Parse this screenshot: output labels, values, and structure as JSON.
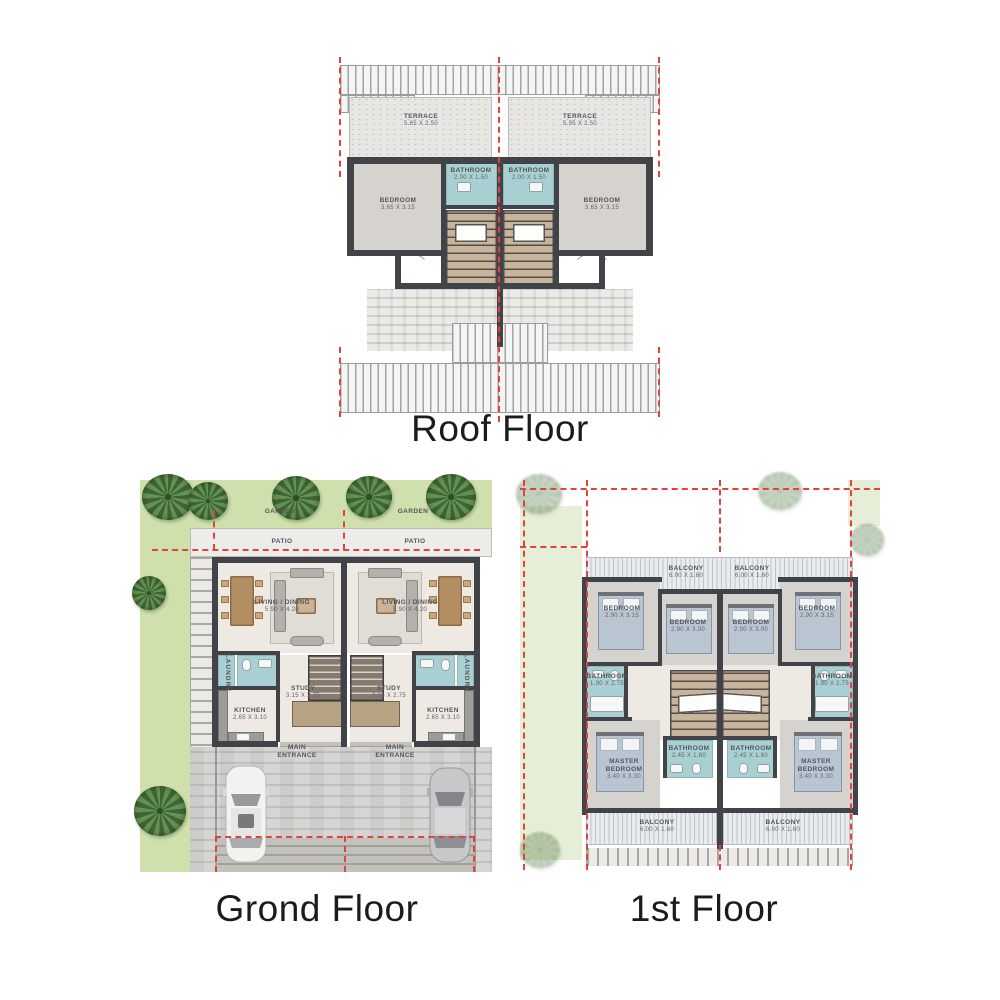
{
  "titles": {
    "roof": "Roof Floor",
    "ground": "Grond Floor",
    "first": "1st Floor"
  },
  "roof": {
    "terrace_left": {
      "label": "TERRACE",
      "dims": "5.65 X 2.50"
    },
    "terrace_right": {
      "label": "TERRACE",
      "dims": "5.95 X 2.50"
    },
    "bathroom_left": {
      "label": "BATHROOM",
      "dims": "2.00 X 1.50"
    },
    "bathroom_right": {
      "label": "BATHROOM",
      "dims": "2.00 X 1.50"
    },
    "bedroom_left": {
      "label": "BEDROOM",
      "dims": "3.65 X 3.15"
    },
    "bedroom_right": {
      "label": "BEDROOM",
      "dims": "3.65 X 3.15"
    }
  },
  "ground": {
    "garden_left": {
      "label": "GARDEN"
    },
    "garden_right": {
      "label": "GARDEN"
    },
    "patio_left": {
      "label": "PATIO"
    },
    "patio_right": {
      "label": "PATIO"
    },
    "living_left": {
      "label": "LIVING / DINING",
      "dims": "5.90 X 4.20"
    },
    "living_right": {
      "label": "LIVING / DINING",
      "dims": "5.90 X 4.20"
    },
    "laundry_left": {
      "label": "LAUNDRY"
    },
    "laundry_right": {
      "label": "LAUNDRY"
    },
    "study_left": {
      "label": "STUDY",
      "dims": "3.15 X 2.75"
    },
    "study_right": {
      "label": "STUDY",
      "dims": "3.15 X 2.75"
    },
    "kitchen_left": {
      "label": "KITCHEN",
      "dims": "2.65 X 3.10"
    },
    "kitchen_right": {
      "label": "KITCHEN",
      "dims": "2.65 X 3.10"
    },
    "entrance_left": {
      "label": "MAIN ENTRANCE"
    },
    "entrance_right": {
      "label": "MAIN ENTRANCE"
    }
  },
  "first": {
    "balcony_top_left": {
      "label": "BALCONY",
      "dims": "6.00 X 1.60"
    },
    "balcony_top_right": {
      "label": "BALCONY",
      "dims": "6.00 X 1.60"
    },
    "bedroom_outer_left": {
      "label": "BEDROOM",
      "dims": "2.90 X 3.15"
    },
    "bedroom_inner_left": {
      "label": "BEDROOM",
      "dims": "2.90 X 3.00"
    },
    "bedroom_inner_right": {
      "label": "BEDROOM",
      "dims": "2.90 X 3.00"
    },
    "bedroom_outer_right": {
      "label": "BEDROOM",
      "dims": "2.90 X 3.15"
    },
    "bathroom_side_left": {
      "label": "BATHROOM",
      "dims": "1.90 X 2.75"
    },
    "bathroom_side_right": {
      "label": "BATHROOM",
      "dims": "1.90 X 2.75"
    },
    "bathroom_mid_left": {
      "label": "BATHROOM",
      "dims": "2.45 X 1.60"
    },
    "bathroom_mid_right": {
      "label": "BATHROOM",
      "dims": "2.45 X 1.60"
    },
    "master_left": {
      "label": "MASTER BEDROOM",
      "dims": "3.40 X 3.30"
    },
    "master_right": {
      "label": "MASTER BEDROOM",
      "dims": "3.40 X 3.30"
    },
    "balcony_bottom_left": {
      "label": "BALCONY",
      "dims": "6.00 X 1.60"
    },
    "balcony_bottom_right": {
      "label": "BALCONY",
      "dims": "6.00 X 1.60"
    }
  },
  "colors": {
    "wall": "#424348",
    "bathroom": "#a8d0d2",
    "room_floor": "#d6d2cd",
    "cream_floor": "#eee9e2",
    "stairs": "#c7b49a",
    "garden": "#cfe0ad",
    "red_dash": "#e0433c",
    "title_text": "#1b1b1d",
    "label_text": "#54555a"
  }
}
